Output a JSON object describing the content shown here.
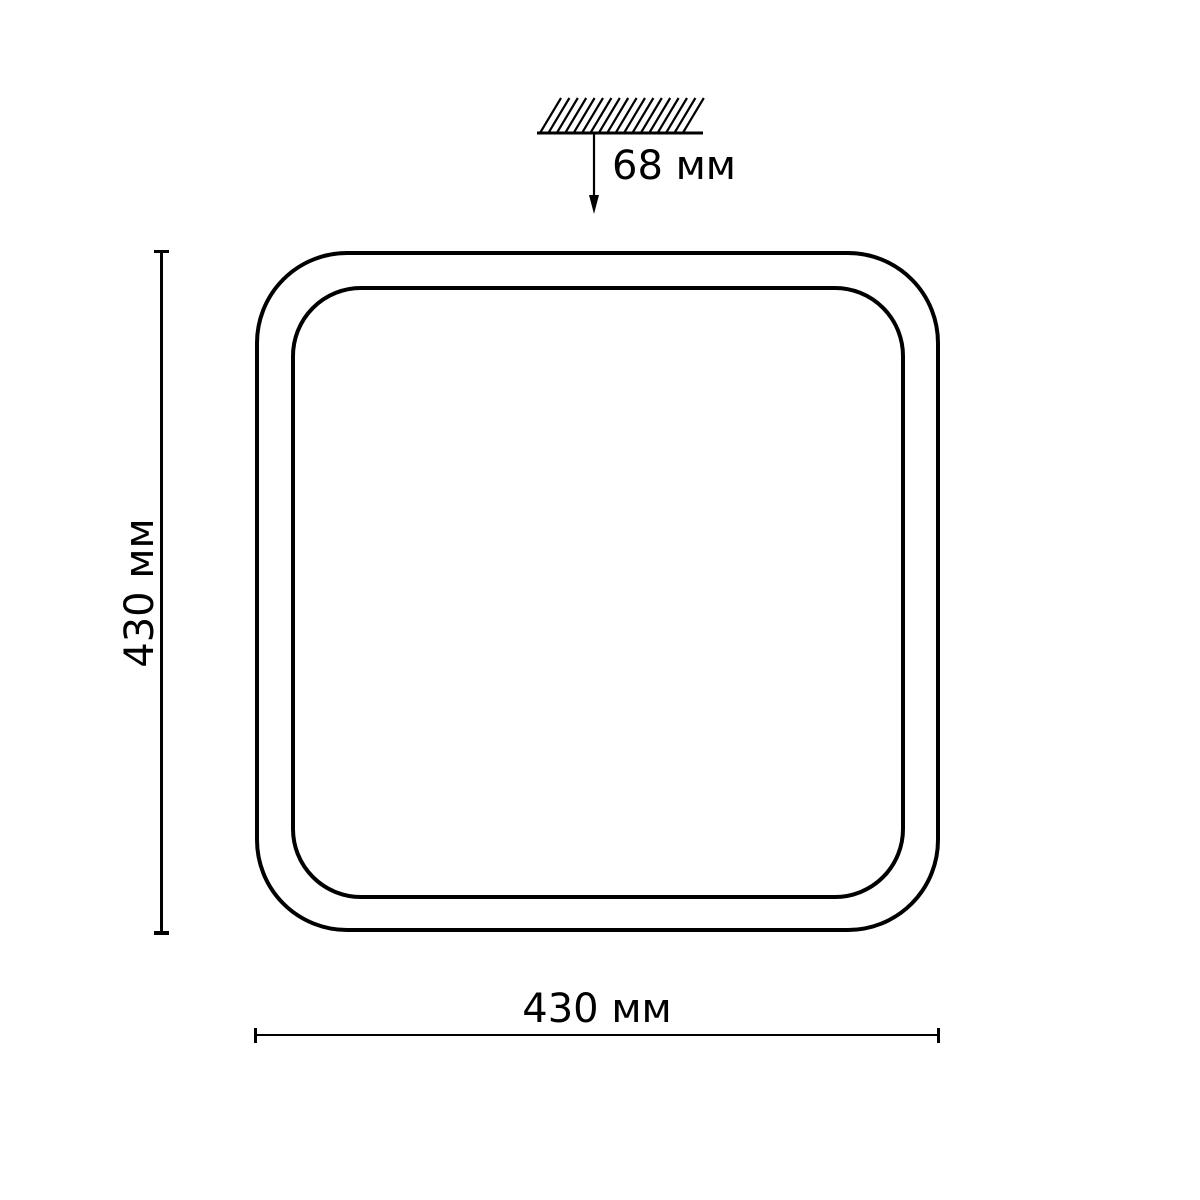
{
  "diagram": {
    "mount_height_label": "68 мм",
    "vertical_dimension_label": "430 мм",
    "horizontal_dimension_label": "430 мм"
  },
  "colors": {
    "line": "#000000",
    "background": "#ffffff"
  },
  "icons": {
    "ceiling_hatch": "hatched-ceiling-mounting-surface",
    "height_arrow": "downward-arrow-from-ceiling"
  }
}
